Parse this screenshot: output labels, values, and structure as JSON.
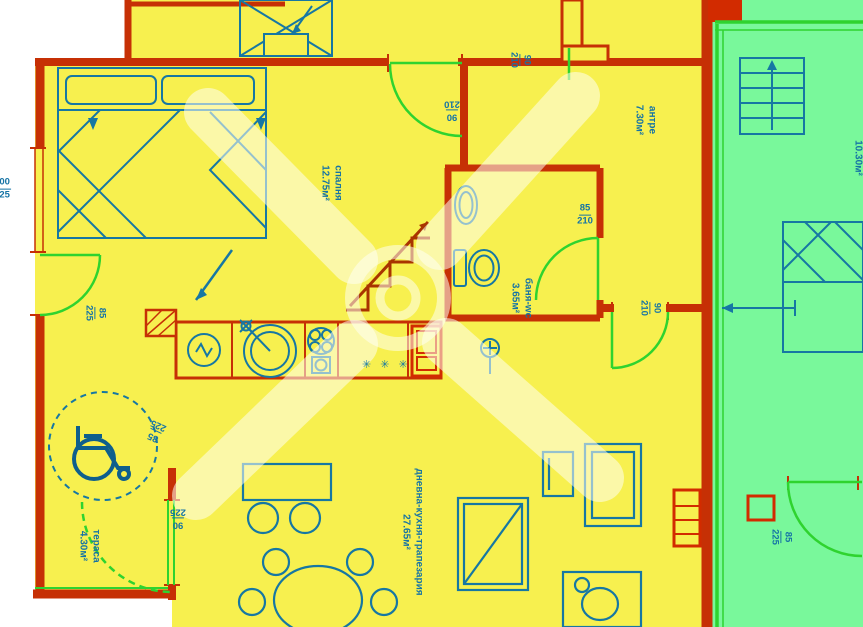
{
  "plan_title": "apartment-floor-plan",
  "colors": {
    "apartment_fill": "#F7F04F",
    "adjacent_fill": "#79F89B",
    "wall": "#C63005",
    "wall_dark": "#A83400",
    "furniture": "#1677A3",
    "door_swing": "#2FD32F",
    "label_text": "#1573A5",
    "watermark": "rgba(255,255,242,0.55)"
  },
  "rooms": {
    "bedroom": {
      "name": "спалня",
      "area": "12.75м²"
    },
    "entry": {
      "name": "антре",
      "area": "7.30м²"
    },
    "bathroom": {
      "name": "баня-wc",
      "area": "3.65м²"
    },
    "living": {
      "name": "дневна-кухня-трапезария",
      "area": "27.65м²"
    },
    "terrace": {
      "name": "тераса",
      "area": "4.30м²"
    },
    "adjacent": {
      "area": "10.30м²"
    }
  },
  "dimensions": {
    "door_top": {
      "w": "90",
      "h": "210"
    },
    "door_top2": {
      "w": "90",
      "h": "210"
    },
    "door_bath": {
      "w": "85",
      "h": "210"
    },
    "door_entry": {
      "w": "90",
      "h": "210"
    },
    "door_bedroom": {
      "w": "85",
      "h": "225"
    },
    "door_kitchen": {
      "w": "85",
      "h": "225"
    },
    "door_terrace": {
      "w": "90",
      "h": "225"
    },
    "door_adjacent": {
      "w": "85",
      "h": "225"
    },
    "window_left": {
      "w": "200",
      "h": "225"
    }
  },
  "symbols": {
    "fridge_marks": "✳ ✳ ✳"
  }
}
